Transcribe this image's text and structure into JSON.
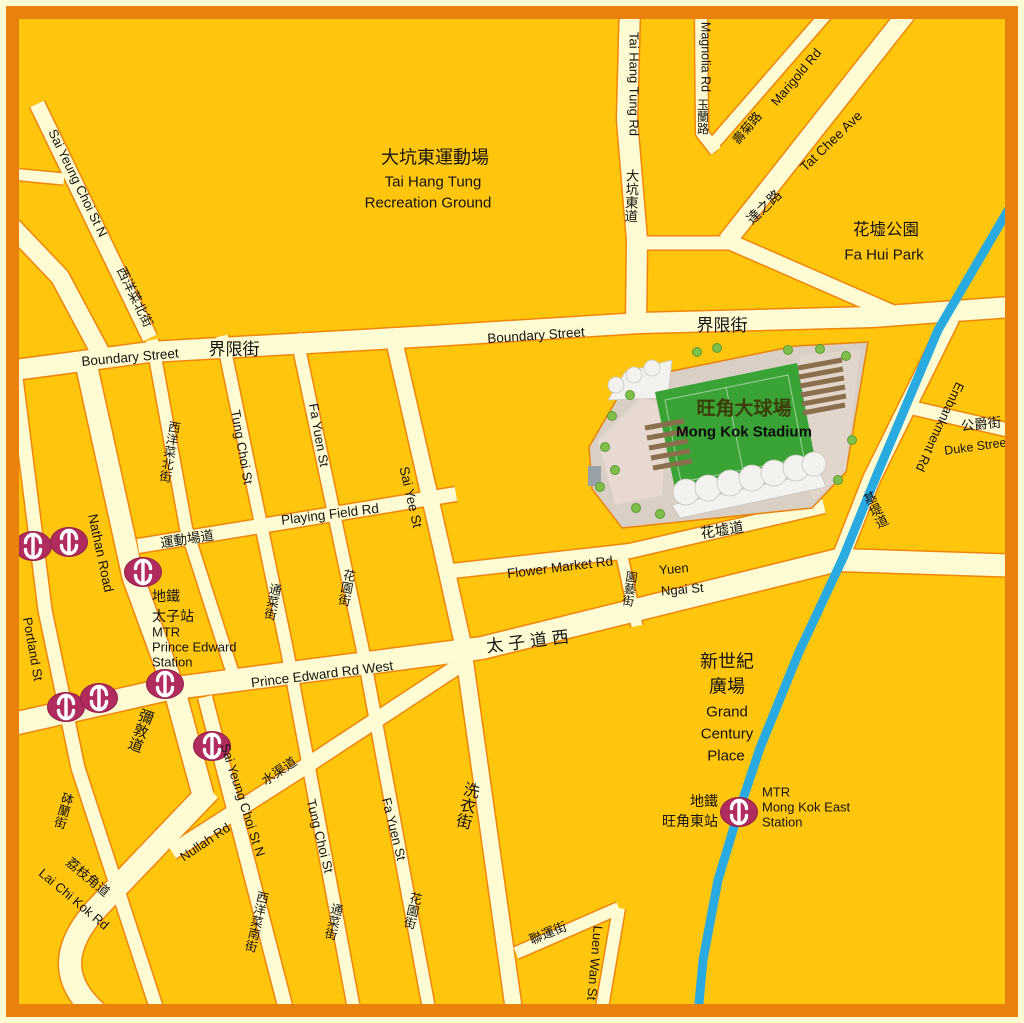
{
  "map": {
    "description": "Street map of Mong Kok / Prince Edward area, Hong Kong, centered on Mong Kok Stadium",
    "colors": {
      "background": "#FFC60D",
      "road_fill": "#FFFBD2",
      "road_casing": "#EE850D",
      "frame_border": "#E8820C",
      "canal_blue": "#29ABE2",
      "mtr_logo": "#B02B5E",
      "stadium_pitch": "#3AA336",
      "stadium_site": "#D9CFC4",
      "label_text": "#141414"
    },
    "legend_icons": [
      {
        "name": "mtr-station-icon",
        "meaning": "MTR station entrance"
      }
    ]
  },
  "mtr_icon_positions": [
    {
      "x": 33,
      "y": 546
    },
    {
      "x": 69,
      "y": 542
    },
    {
      "x": 143,
      "y": 572
    },
    {
      "x": 165,
      "y": 684
    },
    {
      "x": 66,
      "y": 707
    },
    {
      "x": 99,
      "y": 698
    },
    {
      "x": 212,
      "y": 746
    },
    {
      "x": 739,
      "y": 812
    }
  ],
  "labels": [
    {
      "id": "sai-yeung-choi-st-n-upper-en",
      "t": "Sai Yeung Choi St N",
      "x": 78,
      "y": 183,
      "r": 64,
      "s": 13
    },
    {
      "id": "sai-yeung-choi-st-n-upper-zh",
      "t": "西洋菜北街",
      "x": 135,
      "y": 297,
      "r": 64,
      "s": 13
    },
    {
      "id": "tai-hang-tung-recreation-ground-zh",
      "t": "大坑東運動場",
      "x": 435,
      "y": 157,
      "r": 0,
      "s": 18
    },
    {
      "id": "tai-hang-tung-recreation-ground-en-1",
      "t": "Tai Hang Tung",
      "x": 433,
      "y": 181,
      "r": 0,
      "s": 15
    },
    {
      "id": "tai-hang-tung-recreation-ground-en-2",
      "t": "Recreation Ground",
      "x": 428,
      "y": 202,
      "r": 0,
      "s": 15
    },
    {
      "id": "tai-hang-tung-rd-en",
      "t": "Tai Hang Tung Rd",
      "x": 634,
      "y": 84,
      "r": 90,
      "s": 13
    },
    {
      "id": "tai-hang-tung-rd-zh",
      "t": "大坑東道",
      "x": 632,
      "y": 196,
      "r": 2,
      "s": 13.5,
      "stack": true
    },
    {
      "id": "magnolia-rd-en",
      "t": "Magnolia Rd",
      "x": 706,
      "y": 57,
      "r": 90,
      "s": 12.5
    },
    {
      "id": "magnolia-rd-zh",
      "t": "玉蘭路",
      "x": 703,
      "y": 117,
      "r": 0,
      "s": 12,
      "stack": true
    },
    {
      "id": "marigold-rd-zh",
      "t": "壽菊路",
      "x": 747,
      "y": 128,
      "r": -50,
      "s": 12.5
    },
    {
      "id": "marigold-rd-en",
      "t": "Marigold Rd",
      "x": 796,
      "y": 77,
      "r": -50,
      "s": 13
    },
    {
      "id": "tat-chee-ave-en",
      "t": "Tat Chee Ave",
      "x": 831,
      "y": 141,
      "r": -44,
      "s": 13.5
    },
    {
      "id": "tat-chee-ave-zh",
      "t": "達之路",
      "x": 764,
      "y": 207,
      "r": -44,
      "s": 14
    },
    {
      "id": "fa-hui-park-zh",
      "t": "花墟公園",
      "x": 886,
      "y": 229,
      "r": 0,
      "s": 16.5
    },
    {
      "id": "fa-hui-park-en",
      "t": "Fa Hui Park",
      "x": 884,
      "y": 254,
      "r": 0,
      "s": 15
    },
    {
      "id": "boundary-street-west-en",
      "t": "Boundary Street",
      "x": 130,
      "y": 357,
      "r": -5,
      "s": 13.5
    },
    {
      "id": "boundary-street-west-zh",
      "t": "界限街",
      "x": 234,
      "y": 349,
      "r": 0,
      "s": 17
    },
    {
      "id": "boundary-street-east-en",
      "t": "Boundary Street",
      "x": 536,
      "y": 335,
      "r": -4,
      "s": 13.5
    },
    {
      "id": "boundary-street-east-zh",
      "t": "界限街",
      "x": 722,
      "y": 325,
      "r": 0,
      "s": 17
    },
    {
      "id": "embankment-rd-en",
      "t": "Embankment Rd",
      "x": 940,
      "y": 427,
      "r": 115,
      "s": 13
    },
    {
      "id": "embankment-rd-zh",
      "t": "基堤道",
      "x": 876,
      "y": 510,
      "r": -26,
      "s": 13,
      "stack": true
    },
    {
      "id": "duke-street-zh",
      "t": "公爵街",
      "x": 981,
      "y": 424,
      "r": -6,
      "s": 13.5
    },
    {
      "id": "duke-street-en",
      "t": "Duke Street",
      "x": 977,
      "y": 446,
      "r": -8,
      "s": 12.5
    },
    {
      "id": "sai-yeung-choi-n-grid-zh",
      "t": "西洋菜北街",
      "x": 170,
      "y": 452,
      "r": 10,
      "s": 12.5,
      "stack": true
    },
    {
      "id": "tung-choi-st-upper-en",
      "t": "Tung Choi St",
      "x": 242,
      "y": 447,
      "r": 80,
      "s": 13
    },
    {
      "id": "fa-yuen-st-upper-en",
      "t": "Fa Yuen St",
      "x": 319,
      "y": 435,
      "r": 80,
      "s": 13
    },
    {
      "id": "sai-yee-st-en",
      "t": "Sai Yee St",
      "x": 411,
      "y": 497,
      "r": 77,
      "s": 13.5
    },
    {
      "id": "playing-field-rd-en",
      "t": "Playing Field Rd",
      "x": 330,
      "y": 514,
      "r": -7,
      "s": 13.5
    },
    {
      "id": "playing-field-rd-zh",
      "t": "運動場道",
      "x": 187,
      "y": 539,
      "r": -9,
      "s": 13.5
    },
    {
      "id": "flower-market-rd-en",
      "t": "Flower Market Rd",
      "x": 560,
      "y": 567,
      "r": -7,
      "s": 13.5
    },
    {
      "id": "fa-hui-do-zh",
      "t": "花墟道",
      "x": 722,
      "y": 530,
      "r": -9,
      "s": 14.5
    },
    {
      "id": "yuen-ngai-st-zh",
      "t": "園藝街",
      "x": 630,
      "y": 589,
      "r": 8,
      "s": 12,
      "stack": true
    },
    {
      "id": "yuen-ngai-st-en-1",
      "t": "Yuen",
      "x": 659,
      "y": 570,
      "r": -5,
      "s": 13,
      "a": "start"
    },
    {
      "id": "yuen-ngai-st-en-2",
      "t": "Ngai St",
      "x": 661,
      "y": 591,
      "r": -5,
      "s": 13,
      "a": "start"
    },
    {
      "id": "prince-edward-rd-west-zh",
      "t": "太子道西",
      "x": 530,
      "y": 641,
      "r": -7,
      "s": 17,
      "ls": 5
    },
    {
      "id": "prince-edward-rd-west-en",
      "t": "Prince Edward Rd West",
      "x": 322,
      "y": 674,
      "r": -7,
      "s": 13.5
    },
    {
      "id": "nathan-road-en",
      "t": "Nathan Road",
      "x": 101,
      "y": 553,
      "r": 78,
      "s": 13.5
    },
    {
      "id": "nathan-road-zh",
      "t": "彌敦道",
      "x": 141,
      "y": 731,
      "r": 20,
      "s": 15,
      "stack": true
    },
    {
      "id": "portland-st-en",
      "t": "Portland St",
      "x": 33,
      "y": 649,
      "r": 80,
      "s": 13
    },
    {
      "id": "portland-st-zh",
      "t": "砵蘭街",
      "x": 64,
      "y": 811,
      "r": 16,
      "s": 12.5,
      "stack": true
    },
    {
      "id": "lai-chi-kok-rd-zh",
      "t": "荔枝角道",
      "x": 88,
      "y": 877,
      "r": 40,
      "s": 13
    },
    {
      "id": "lai-chi-kok-rd-en",
      "t": "Lai Chi Kok Rd",
      "x": 74,
      "y": 899,
      "r": 40,
      "s": 13
    },
    {
      "id": "nullah-rd-en",
      "t": "Nullah Rd",
      "x": 205,
      "y": 842,
      "r": -34,
      "s": 13
    },
    {
      "id": "nullah-rd-zh",
      "t": "水渠道",
      "x": 279,
      "y": 771,
      "r": -34,
      "s": 13
    },
    {
      "id": "sai-yeung-choi-st-n-lower-en",
      "t": "Sai Yeung Choi St N",
      "x": 243,
      "y": 800,
      "r": 72,
      "s": 13
    },
    {
      "id": "sai-yeung-choi-s-zh",
      "t": "西洋菜南街",
      "x": 257,
      "y": 922,
      "r": 13,
      "s": 12.5,
      "stack": true
    },
    {
      "id": "tung-choi-st-lower-en",
      "t": "Tung Choi St",
      "x": 320,
      "y": 836,
      "r": 76,
      "s": 13
    },
    {
      "id": "tung-choi-st-lower-zh",
      "t": "通菜街",
      "x": 334,
      "y": 922,
      "r": 13,
      "s": 12.5,
      "stack": true
    },
    {
      "id": "fa-yuen-st-lower-en",
      "t": "Fa Yuen St",
      "x": 394,
      "y": 829,
      "r": 76,
      "s": 13
    },
    {
      "id": "fa-yuen-st-lower-zh",
      "t": "花園街",
      "x": 413,
      "y": 911,
      "r": 13,
      "s": 12.5,
      "stack": true
    },
    {
      "id": "sai-yee-st-lower-zh",
      "t": "洗衣街",
      "x": 468,
      "y": 806,
      "r": 13,
      "s": 16,
      "stack": true
    },
    {
      "id": "luen-wan-st-zh",
      "t": "聯運街",
      "x": 548,
      "y": 933,
      "r": -22,
      "s": 13
    },
    {
      "id": "luen-wan-st-en",
      "t": "Luen Wan St",
      "x": 595,
      "y": 963,
      "r": 95,
      "s": 13
    },
    {
      "id": "tung-choi-st-mid-zh",
      "t": "通菜街",
      "x": 273,
      "y": 602,
      "r": 11,
      "s": 12.5,
      "stack": true
    },
    {
      "id": "fa-yuen-st-mid-zh",
      "t": "花園街",
      "x": 347,
      "y": 588,
      "r": 11,
      "s": 12.5,
      "stack": true
    },
    {
      "id": "mong-kok-stadium-zh",
      "t": "旺角大球場",
      "x": 744,
      "y": 408,
      "r": 0,
      "s": 19,
      "cls": "stadium-zh"
    },
    {
      "id": "mong-kok-stadium-en",
      "t": "Mong Kok Stadium",
      "x": 744,
      "y": 431,
      "r": 0,
      "s": 15,
      "cls": "stadium-en"
    },
    {
      "id": "grand-century-place-zh-1",
      "t": "新世紀",
      "x": 727,
      "y": 661,
      "r": 0,
      "s": 18
    },
    {
      "id": "grand-century-place-zh-2",
      "t": "廣場",
      "x": 727,
      "y": 686,
      "r": 0,
      "s": 18
    },
    {
      "id": "grand-century-place-en-1",
      "t": "Grand",
      "x": 727,
      "y": 711,
      "r": 0,
      "s": 15
    },
    {
      "id": "grand-century-place-en-2",
      "t": "Century",
      "x": 727,
      "y": 733,
      "r": 0,
      "s": 15
    },
    {
      "id": "grand-century-place-en-3",
      "t": "Place",
      "x": 726,
      "y": 755,
      "r": 0,
      "s": 15
    },
    {
      "id": "prince-edward-station-zh-1",
      "t": "地鐵",
      "x": 152,
      "y": 596,
      "r": 0,
      "s": 14,
      "a": "start"
    },
    {
      "id": "prince-edward-station-zh-2",
      "t": "太子站",
      "x": 152,
      "y": 616,
      "r": 0,
      "s": 14,
      "a": "start"
    },
    {
      "id": "prince-edward-station-en-1",
      "t": "MTR",
      "x": 152,
      "y": 632,
      "r": 0,
      "s": 13,
      "a": "start"
    },
    {
      "id": "prince-edward-station-en-2",
      "t": "Prince Edward",
      "x": 152,
      "y": 647,
      "r": 0,
      "s": 13,
      "a": "start"
    },
    {
      "id": "prince-edward-station-en-3",
      "t": "Station",
      "x": 152,
      "y": 662,
      "r": 0,
      "s": 13,
      "a": "start"
    },
    {
      "id": "mong-kok-east-station-zh-1",
      "t": "地鐵",
      "x": 718,
      "y": 801,
      "r": 0,
      "s": 14,
      "a": "end"
    },
    {
      "id": "mong-kok-east-station-zh-2",
      "t": "旺角東站",
      "x": 718,
      "y": 821,
      "r": 0,
      "s": 14,
      "a": "end"
    },
    {
      "id": "mong-kok-east-station-en-1",
      "t": "MTR",
      "x": 762,
      "y": 792,
      "r": 0,
      "s": 13,
      "a": "start"
    },
    {
      "id": "mong-kok-east-station-en-2",
      "t": "Mong Kok East",
      "x": 762,
      "y": 807,
      "r": 0,
      "s": 13,
      "a": "start"
    },
    {
      "id": "mong-kok-east-station-en-3",
      "t": "Station",
      "x": 762,
      "y": 822,
      "r": 0,
      "s": 13,
      "a": "start"
    }
  ]
}
